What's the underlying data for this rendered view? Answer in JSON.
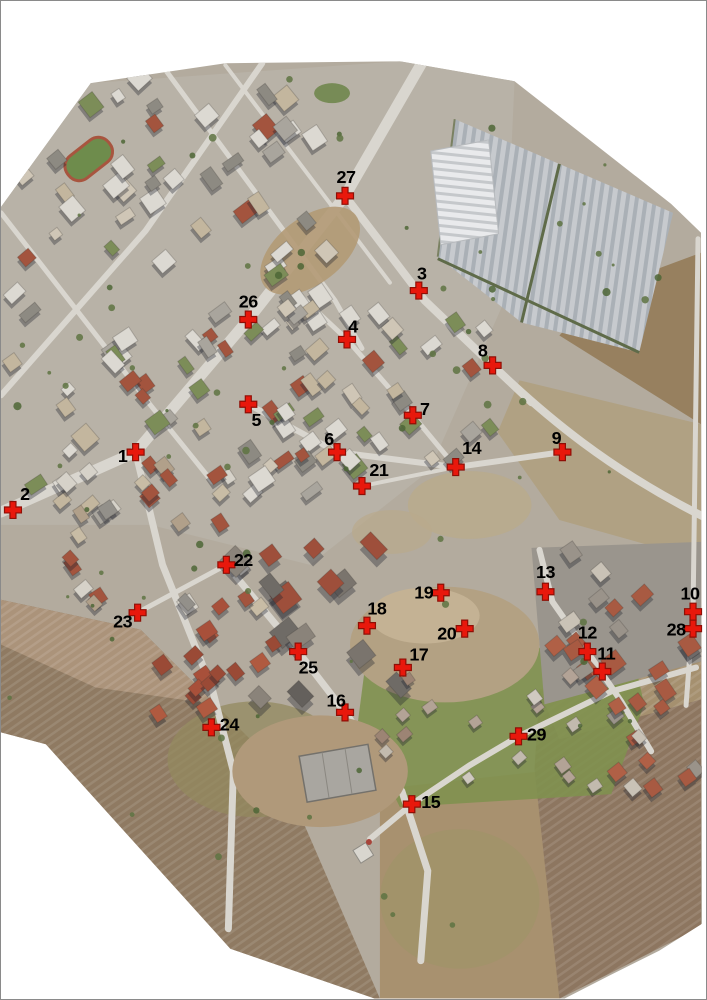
{
  "figure": {
    "kind": "aerial-orthophoto-with-ground-control-points",
    "marker_count": 29,
    "marker_symbol": "red-cross",
    "marker_color": "#e8180c",
    "marker_outline_color": "#8f0f06",
    "label_color": "#000000",
    "canvas_background": "#ffffff",
    "frame_border_color": "#8a8a8a"
  },
  "markers": [
    {
      "id": 1,
      "x": 135,
      "y": 452,
      "dx": -13,
      "dy": 4
    },
    {
      "id": 2,
      "x": 12,
      "y": 510,
      "dx": 12,
      "dy": -16
    },
    {
      "id": 3,
      "x": 419,
      "y": 290,
      "dx": 3,
      "dy": -17
    },
    {
      "id": 4,
      "x": 347,
      "y": 339,
      "dx": 6,
      "dy": -13
    },
    {
      "id": 5,
      "x": 248,
      "y": 404,
      "dx": 8,
      "dy": 16
    },
    {
      "id": 6,
      "x": 337,
      "y": 452,
      "dx": -8,
      "dy": -13
    },
    {
      "id": 7,
      "x": 413,
      "y": 415,
      "dx": 12,
      "dy": -6
    },
    {
      "id": 8,
      "x": 493,
      "y": 365,
      "dx": -10,
      "dy": -15
    },
    {
      "id": 9,
      "x": 563,
      "y": 452,
      "dx": -6,
      "dy": -14
    },
    {
      "id": 10,
      "x": 694,
      "y": 612,
      "dx": -3,
      "dy": -18
    },
    {
      "id": 11,
      "x": 603,
      "y": 672,
      "dx": 4,
      "dy": -18
    },
    {
      "id": 12,
      "x": 588,
      "y": 652,
      "dx": 0,
      "dy": -19
    },
    {
      "id": 13,
      "x": 546,
      "y": 592,
      "dx": 0,
      "dy": -20
    },
    {
      "id": 14,
      "x": 456,
      "y": 467,
      "dx": 16,
      "dy": -19
    },
    {
      "id": 15,
      "x": 412,
      "y": 805,
      "dx": 19,
      "dy": -2
    },
    {
      "id": 16,
      "x": 345,
      "y": 713,
      "dx": -9,
      "dy": -12
    },
    {
      "id": 17,
      "x": 403,
      "y": 668,
      "dx": 16,
      "dy": -13
    },
    {
      "id": 18,
      "x": 367,
      "y": 626,
      "dx": 10,
      "dy": -17
    },
    {
      "id": 19,
      "x": 441,
      "y": 593,
      "dx": -17,
      "dy": 0
    },
    {
      "id": 20,
      "x": 465,
      "y": 629,
      "dx": -18,
      "dy": 5
    },
    {
      "id": 21,
      "x": 362,
      "y": 486,
      "dx": 17,
      "dy": -16
    },
    {
      "id": 22,
      "x": 226,
      "y": 565,
      "dx": 17,
      "dy": -5
    },
    {
      "id": 23,
      "x": 137,
      "y": 613,
      "dx": -15,
      "dy": 9
    },
    {
      "id": 24,
      "x": 211,
      "y": 728,
      "dx": 18,
      "dy": -3
    },
    {
      "id": 25,
      "x": 298,
      "y": 652,
      "dx": 10,
      "dy": 16
    },
    {
      "id": 26,
      "x": 248,
      "y": 319,
      "dx": 0,
      "dy": -18
    },
    {
      "id": 27,
      "x": 345,
      "y": 195,
      "dx": 1,
      "dy": -19
    },
    {
      "id": 28,
      "x": 694,
      "y": 629,
      "dx": -17,
      "dy": 1
    },
    {
      "id": 29,
      "x": 519,
      "y": 737,
      "dx": 18,
      "dy": -2
    }
  ]
}
